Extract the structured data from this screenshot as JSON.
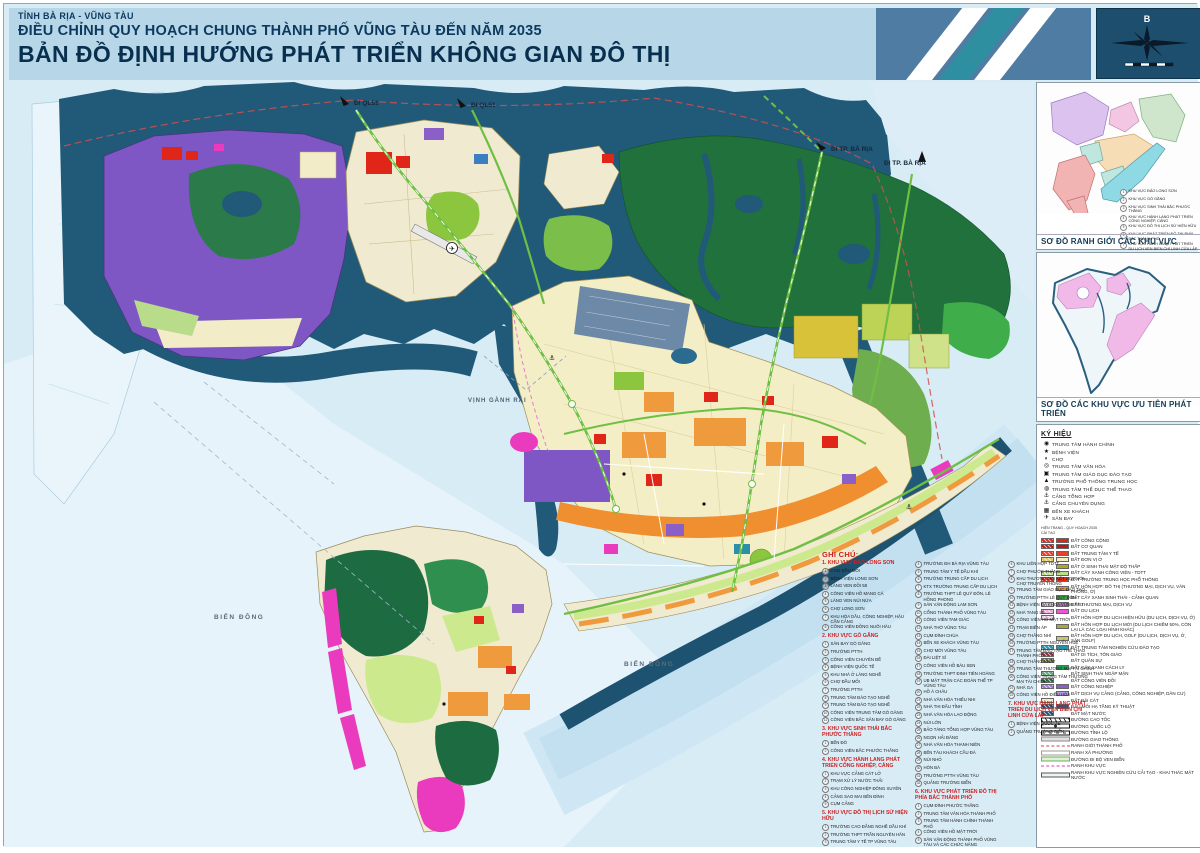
{
  "header": {
    "line1": "TỈNH BÀ RỊA - VŨNG TÀU",
    "line2": "ĐIỀU CHỈNH QUY HOẠCH CHUNG THÀNH PHỐ VŨNG TÀU ĐẾN NĂM 2035",
    "line3": "BẢN ĐỒ ĐỊNH HƯỚNG PHÁT TRIỂN KHÔNG GIAN ĐÔ THỊ"
  },
  "compass": {
    "north": "B"
  },
  "map_labels": {
    "di_ql51_a": "ĐI QL51",
    "di_ql51_b": "ĐI QL51",
    "di_ba_ria_a": "ĐI TP. BÀ RỊA",
    "di_ba_ria_b": "ĐI TP. BÀ RỊA",
    "vinh_ganh_rai": "VỊNH GÀNH RÁI",
    "bien_dong_a": "BIỂN ĐÔNG",
    "bien_dong_b": "BIỂN ĐÔNG"
  },
  "sidebar": {
    "inset1": {
      "caption": "SƠ ĐỒ RANH GIỚI CÁC KHU VỰC",
      "legend": [
        {
          "label": "KHU VỰC ĐẢO LONG SƠN"
        },
        {
          "label": "KHU VỰC GÒ GĂNG"
        },
        {
          "label": "KHU VỰC SINH THÁI BẮC PHƯỚC THẮNG"
        },
        {
          "label": "KHU VỰC HÀNH LANG PHÁT TRIỂN CÔNG NGHIỆP, CẢNG"
        },
        {
          "label": "KHU VỰC ĐÔ THỊ LỊCH SỬ HIỆN HỮU"
        },
        {
          "label": "KHU VỰC PHÁT TRIỂN ĐÔ THỊ PHÍA BẮC THÀNH PHỐ"
        },
        {
          "label": "KHU VỰC HÀNH LANG PHÁT TRIỂN DU LỊCH VEN BIỂN CHÍ LINH CỬA LẤP"
        }
      ]
    },
    "inset2": {
      "caption": "SƠ ĐỒ CÁC KHU VỰC ƯU TIÊN PHÁT TRIỂN"
    },
    "symbols": {
      "title": "KÝ HIỆU",
      "items": [
        {
          "label": "TRUNG TÂM HÀNH CHÍNH",
          "glyph": "◉",
          "icon": "admin-center-icon"
        },
        {
          "label": "BỆNH VIỆN",
          "glyph": "★",
          "icon": "hospital-icon"
        },
        {
          "label": "CHỢ",
          "glyph": "◐",
          "icon": "market-icon"
        },
        {
          "label": "TRUNG TÂM VĂN HÓA",
          "glyph": "◎",
          "icon": "culture-center-icon"
        },
        {
          "label": "TRUNG TÂM GIÁO DỤC ĐÀO TẠO",
          "glyph": "▣",
          "icon": "education-center-icon"
        },
        {
          "label": "TRƯỜNG PHỔ THÔNG TRUNG HỌC",
          "glyph": "▲",
          "icon": "high-school-icon"
        },
        {
          "label": "TRUNG TÂM THỂ DỤC THỂ THAO",
          "glyph": "◍",
          "icon": "sports-center-icon"
        },
        {
          "label": "CẢNG TỔNG HỢP",
          "glyph": "⚓",
          "icon": "general-port-icon"
        },
        {
          "label": "CẢNG CHUYÊN DỤNG",
          "glyph": "⚓",
          "icon": "specialized-port-icon"
        },
        {
          "label": "BẾN XE KHÁCH",
          "glyph": "▦",
          "icon": "bus-station-icon"
        },
        {
          "label": "SÂN BAY",
          "glyph": "✈",
          "icon": "airport-icon"
        }
      ]
    },
    "legend": {
      "title": "CHÚ THÍCH",
      "col_header_1": "HIỆN TRẠNG - QUY HOẠCH 2035",
      "col_header_2": "CẢI TẠO",
      "items": [
        {
          "label": "ĐẤT CÔNG CỘNG",
          "c1": "#e02619",
          "c2": "#e02619"
        },
        {
          "label": "ĐẤT CƠ QUAN",
          "c1": "#c01818",
          "c2": "#c01818"
        },
        {
          "label": "ĐẤT TRUNG TÂM Y TẾ",
          "c1": "#e8402a",
          "c2": "#e8402a"
        },
        {
          "label": "ĐẤT ĐƠN VỊ Ở",
          "c1": "#e8c84a",
          "c2": "#f5efc0"
        },
        {
          "label": "ĐẤT Ở SINH THÁI MẬT ĐỘ THẤP",
          "c2": "#b2a525"
        },
        {
          "label": "ĐẤT CÂY XANH CÔNG VIÊN - TDTT",
          "c1": "#b9e086",
          "c2": "#b9e086"
        },
        {
          "label": "ĐẤT TRƯỜNG TRUNG HỌC PHỔ THÔNG",
          "c1": "#e02619",
          "c2": "#e02619"
        },
        {
          "label": "ĐẤT HỖN HỢP: ĐÔ THỊ (THƯƠNG MẠI, DỊCH VỤ, VĂN PHÒNG, Ở)",
          "c2": "#ef8f2f"
        },
        {
          "label": "ĐẤT CÂY XANH SINH THÁI - CẢNH QUAN",
          "c2": "#3da344"
        },
        {
          "label": "ĐẤT THƯƠNG MẠI, DỊCH VỤ",
          "c1": "#d9b3d9",
          "c2": "#b76fc0"
        },
        {
          "label": "ĐẤT DU LỊCH",
          "c1": "#f2a3e0",
          "c2": "#ee54d4"
        },
        {
          "label": "ĐẤT HỖN HỢP DU LỊCH HIỆN HỮU (DU LỊCH, DỊCH VỤ, Ở)",
          "c1": "#f2c8ea"
        },
        {
          "label": "ĐẤT HỖN HỢP DU LỊCH MỚI (DU LỊCH CHIẾM 50%, CÒN LẠI LÀ CÁC LOẠI HÌNH KHÁC)",
          "c2": "#a8a83c"
        },
        {
          "label": "ĐẤT HỖN HỢP DU LỊCH, GOLF (DU LỊCH, DỊCH VỤ, Ở, SÂN GOLF)",
          "c2": "#c8c86a"
        },
        {
          "label": "ĐẤT TRUNG TÂM NGHIÊN CỨU ĐÀO TẠO",
          "c1": "#2a8fa8",
          "c2": "#2a8fa8"
        },
        {
          "label": "ĐẤT DI TÍCH, TÔN GIÁO",
          "c1": "#93243a"
        },
        {
          "label": "ĐẤT QUÂN SỰ",
          "c1": "#6e6e2e"
        },
        {
          "label": "ĐẤT CÂY XANH CÁCH LY",
          "c2": "#1f9e50"
        },
        {
          "label": "ĐẤT SINH THÁI NGẬP MẶN",
          "c1": "#5fa87d"
        },
        {
          "label": "ĐẤT CÔNG VIÊN ĐỒI",
          "c1": "#1a6e3c"
        },
        {
          "label": "ĐẤT CÔNG NGHIỆP",
          "c1": "#9a78d0",
          "c2": "#8a5fc8"
        },
        {
          "label": "ĐẤT DỊCH VỤ CẢNG (CẢNG, CÔNG NGHIỆP, DÂN CƯ)",
          "c2": "#b49ae0"
        },
        {
          "label": "ĐẤT BÃI CÁT",
          "c1": "#f0e8c0"
        },
        {
          "label": "ĐẦU MỐI HẠ TẦNG KỸ THUẬT",
          "c1": "#2a3f6e",
          "c2": "#3a4f80"
        },
        {
          "label": "ĐẤT MẶT NƯỚC",
          "c1": "#1d4e6b"
        },
        {
          "label": "ĐƯỜNG CAO TỐC",
          "kind": "cao-toc"
        },
        {
          "label": "ĐƯỜNG QUỐC LỘ",
          "kind": "quoc-lo"
        },
        {
          "label": "ĐƯỜNG TỈNH LỘ",
          "kind": "tinh-lo"
        },
        {
          "label": "ĐƯỜNG GIAO THÔNG",
          "kind": "giao-thong"
        },
        {
          "label": "RANH GIỚI THÀNH PHỐ",
          "kind": "ranh-tp"
        },
        {
          "label": "RANH XÃ PHƯỜNG",
          "kind": "ranh-xa"
        },
        {
          "label": "ĐƯỜNG ĐI BỘ VEN BIỂN",
          "kind": "di-bo"
        },
        {
          "label": "RANH KHU VỰC",
          "kind": "ranh-kv"
        },
        {
          "label": "RANH KHU VỰC NGHIÊN CỨU CẢI TẠO - KHAI THÁC MẶT NƯỚC",
          "kind": "ranh-nc"
        }
      ]
    }
  },
  "notes": {
    "title": "GHI CHÚ:",
    "sections": [
      {
        "title": "1. KHU VỰC ĐẢO LONG SƠN",
        "items": [
          "CHỢ ĐẦU MỐI",
          "BỆNH VIỆN LONG SƠN",
          "LÀNG VEN ĐỒI 58",
          "CÔNG VIÊN HỒ MANG CÁ",
          "LÀNG VEN NÚI NỨA",
          "CHỢ LONG SƠN",
          "KHU HÓA DẦU, CÔNG NGHIỆP, HẬU CẦN CẢNG",
          "CÔNG VIÊN ĐỒNG NUÔI HÀU"
        ]
      },
      {
        "title": "2. KHU VỰC GÒ GĂNG",
        "items": [
          "SÂN BAY GÒ GĂNG",
          "TRƯỜNG PTTH",
          "CÔNG VIÊN CHUYÊN ĐỀ",
          "BỆNH VIỆN QUỐC TẾ",
          "KHU NHÀ Ở LÀNG NGHỀ",
          "CHỢ ĐẦU MỐI",
          "TRƯỜNG PTTH",
          "TRUNG TÂM ĐÀO TẠO NGHỀ",
          "TRUNG TÂM ĐÀO TẠO NGHỀ",
          "CÔNG VIÊN TRUNG TÂM GÒ GĂNG",
          "CÔNG VIÊN BẮC SÂN BAY GÒ GĂNG"
        ]
      },
      {
        "title": "3. KHU VỰC SINH THÁI BẮC PHƯỚC THẮNG",
        "items": [
          "BẾN ĐÒ",
          "CÔNG VIÊN BẮC PHƯỚC THẮNG"
        ]
      },
      {
        "title": "4. KHU VỰC HÀNH LANG PHÁT TRIỂN CÔNG NGHIỆP, CẢNG",
        "items": [
          "KHU VỰC CẢNG CÁT LỞ",
          "TRẠM XỬ LÝ NƯỚC THẢI",
          "KHU CÔNG NGHIỆP ĐÔNG XUYÊN",
          "CẢNG SAO MAI BẾN ĐÌNH",
          "CỤM CẢNG"
        ]
      },
      {
        "title": "5. KHU VỰC ĐÔ THỊ LỊCH SỬ HIỆN HỮU",
        "items": [
          "TRƯỜNG CAO ĐẲNG NGHỀ DẦU KHÍ",
          "TRƯỜNG THPT TRẦN NGUYÊN HÃN",
          "TRUNG TÂM Y TẾ TP VŨNG TÀU",
          "TRƯỜNG ĐH BÀ RỊA VŨNG TÀU",
          "TRUNG TÂM Y TẾ DẦU KHÍ",
          "TRƯỜNG TRUNG CẤP DU LỊCH",
          "KTX TRƯỜNG TRUNG CẤP DU LỊCH",
          "TRƯỜNG THPT LÊ QUÝ ĐÔN, LÊ HỒNG PHONG",
          "SÂN VẬN ĐỘNG LAM SƠN",
          "CỔNG THÀNH PHỐ VŨNG TÀU",
          "CÔNG VIÊN TAM GIÁC",
          "NHÀ THỜ VŨNG TÀU",
          "CỤM ĐÌNH CHÙA",
          "BẾN XE KHÁCH VŨNG TÀU",
          "CHỢ MỚI VŨNG TÀU",
          "ĐÀI LIỆT SĨ",
          "CÔNG VIÊN HỒ BÀU SEN",
          "TRƯỜNG THPT ĐINH TIÊN HOÀNG",
          "UB MẶT TRẬN CÁC ĐOÀN THỂ TP VŨNG TÀU",
          "HỒ Á CHÂU",
          "NHÀ VĂN HÓA THIẾU NHI",
          "NHÀ THI ĐẤU TỈNH",
          "NHÀ VĂN HÓA LAO ĐỘNG",
          "NÚI LỚN",
          "BẢO TÀNG TỔNG HỢP VŨNG TÀU",
          "NGỌN HẢI ĐĂNG",
          "NHÀ VĂN HÓA THANH NIÊN",
          "BẾN TÀU KHÁCH CẦU ĐÁ",
          "NÚI NHỎ",
          "HÒN BÀ",
          "TRƯỜNG PTTH VŨNG TÀU",
          "QUẢNG TRƯỜNG BIỂN"
        ]
      },
      {
        "title": "6. KHU VỰC PHÁT TRIỂN ĐÔ THỊ PHÍA BẮC THÀNH PHỐ",
        "items": [
          "CỤM ĐÌNH PHƯỚC THẮNG",
          "TRUNG TÂM VĂN HÓA THÀNH PHỐ",
          "TRUNG TÂM HÀNH CHÍNH THÀNH PHỐ",
          "CÔNG VIÊN HỒ MẶT TRỜI",
          "SÂN VẬN ĐỘNG THÀNH PHỐ VŨNG TÀU VÀ CÁC CHỨC NĂNG",
          "KHU LIÊN HỢP TDTT",
          "CHỢ PHƯỚC THẮNG",
          "KHU THƯƠNG MẠI KẾT HỢP VỚI CHỢ TRUYỀN THỐNG",
          "TRUNG TÂM GIÁO DỤC ĐÀO TẠO",
          "TRƯỜNG PTTH LÊ QUÝ ĐÔN",
          "BỆNH VIỆN ĐA KHOA VŨNG TÀU",
          "NHÀ TANG LỄ",
          "CÔNG VIÊN HỒ MẶT TRỜI",
          "TRẠM BIẾN ÁP",
          "CHỢ THẮNG NHÌ",
          "TRƯỜNG PTTH NGUYỄN HUỆ",
          "TRUNG TÂM ĐÀO TẠO THỂ THAO THÀNH PHỐ",
          "CHỢ THẮNG NHẤT",
          "TRUNG TÂM THƯƠNG MẠI TÀI CHÍNH",
          "CÔNG VIÊN TRUNG TÂM THƯƠNG MẠI TÀI CHÍNH",
          "NHÀ GA",
          "CÔNG VIÊN HỒ ĐIỀU HÒA"
        ]
      },
      {
        "title": "7. KHU VỰC HÀNH LANG PHÁT TRIỂN DU LỊCH VEN BIỂN CHÍ LINH CỬA LẤP",
        "items": [
          "BỆNH VIỆN QUỐC TẾ",
          "QUẢNG TRƯỜNG BIỂN"
        ]
      }
    ]
  }
}
